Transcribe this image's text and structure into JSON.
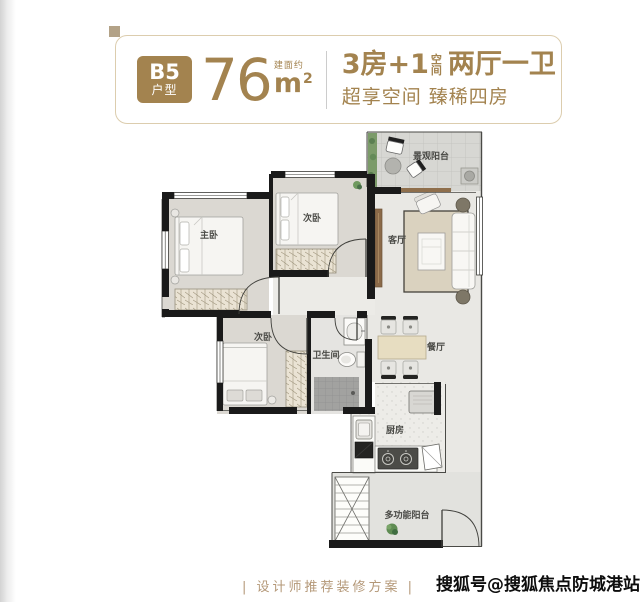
{
  "header": {
    "badge": {
      "line1": "B5",
      "line2": "户型"
    },
    "area": {
      "value": "76",
      "note": "建面约",
      "unit": "m",
      "sup": "2"
    },
    "title_left": "3房+1",
    "title_stack_top": "空",
    "title_stack_bottom": "间",
    "title_right": "两厅一卫",
    "subtitle": "超享空间 臻稀四房",
    "accent_color": "#a3834f"
  },
  "floorplan": {
    "rooms": [
      {
        "label": "景观阳台"
      },
      {
        "label": "次卧"
      },
      {
        "label": "主卧"
      },
      {
        "label": "客厅"
      },
      {
        "label": "次卧"
      },
      {
        "label": "卫生间"
      },
      {
        "label": "餐厅"
      },
      {
        "label": "厨房"
      },
      {
        "label": "多功能阳台"
      }
    ],
    "wall_color": "#1a1a1a"
  },
  "footer": {
    "caption": "| 设计师推荐装修方案 |",
    "caption_color": "#b49878",
    "watermark": "搜狐号@搜狐焦点防城港站"
  }
}
